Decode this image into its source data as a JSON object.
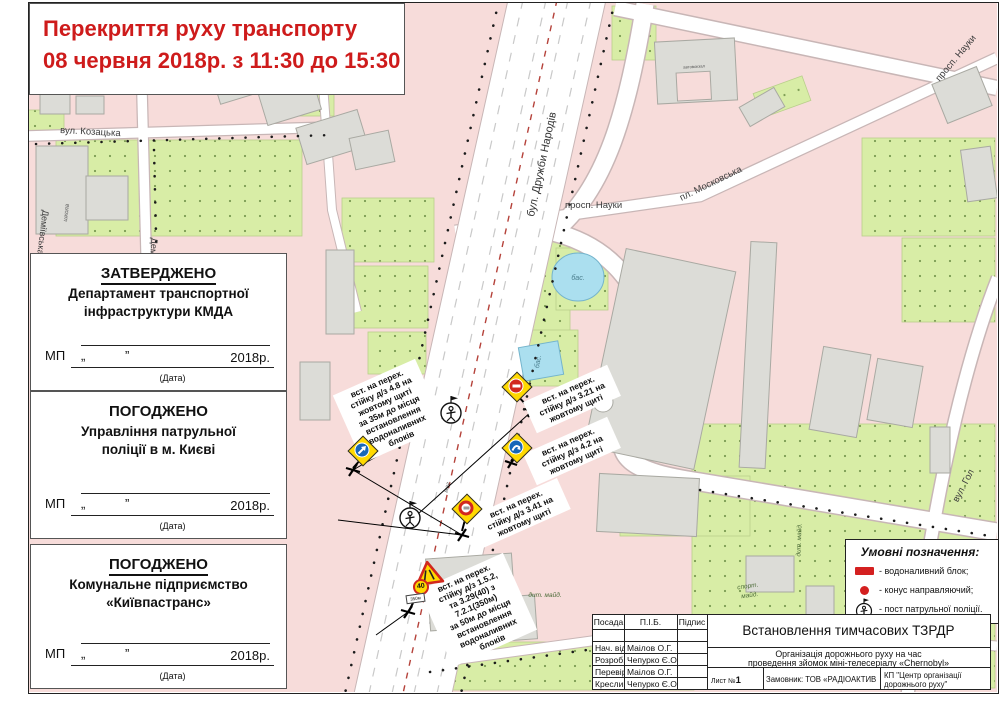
{
  "page_title": {
    "line1": "Перекриття руху транспорту",
    "line2": "08 червня 2018р. з 11:30 до 15:30"
  },
  "approvals": [
    {
      "heading": "ЗАТВЕРДЖЕНО",
      "org1": "Департамент транспортної",
      "org2": "інфраструктури КМДА"
    },
    {
      "heading": "ПОГОДЖЕНО",
      "org1": "Управління патрульної",
      "org2": "поліції в м. Києві"
    },
    {
      "heading": "ПОГОДЖЕНО",
      "org1": "Комунальне підприємство",
      "org2": "«Київпастранс»"
    }
  ],
  "mp_row": {
    "mp": "МП",
    "q1": "„",
    "q2": "”",
    "year": "2018р.",
    "date": "(Дата)"
  },
  "legend": {
    "title": "Умовні позначення:",
    "items": [
      {
        "icon": "water-fill-block-icon",
        "label": "- водоналивний блок;"
      },
      {
        "icon": "guide-cone-icon",
        "label": "- конус направляючий;"
      },
      {
        "icon": "police-post-icon",
        "label": "- пост патрульної поліції."
      }
    ]
  },
  "title_block": {
    "col_posada": "Посада",
    "col_pib": "П.І.Б.",
    "col_pidpys": "Підпис",
    "rows": [
      {
        "role": "Нач. від.",
        "name": "Маілов  О.Г."
      },
      {
        "role": "Розроб.",
        "name": "Чепурко Є.О."
      },
      {
        "role": "Перевір.",
        "name": "Маілов  О.Г."
      },
      {
        "role": "Креслив.",
        "name": "Чепурко Є.О."
      }
    ],
    "doc_title": "Встановлення тимчасових ТЗРДР",
    "subtitle1": "Організація дорожнього руху на час",
    "subtitle2": "проведення зйомок міні-телесеріалу «Chernobyl»",
    "sheet_label": "Лист №",
    "sheet_number": "1",
    "customer": "Замовник: ТОВ «РАДІОАКТИВ СІНЕМА»",
    "company1": "КП \"Центр організації",
    "company2": "дорожнього руху\""
  },
  "annotations": [
    {
      "text": "вст. на перех.\nстійку д/з 4.8 на\nжовтому щиті\nза 35м до місця\nвстановлення\nводоналивних\nблоків"
    },
    {
      "text": "вст. на перех.\nстійку д/з 3.21 на\nжовтому щиті"
    },
    {
      "text": "вст. на перех.\nстійку д/з 4.2 на\nжовтому щиті"
    },
    {
      "text": "вст. на перех.\nстійку д/з 3.41 на\nжовтому щиті"
    },
    {
      "text": "вст. на перех.\nстійку д/з 1.5.2,\nта 3.29(40) з\n7.2.1(350м)\nза 50м до місця\nвстановлення\nводоналивних\nблоків"
    }
  ],
  "signs": {
    "speed": "40",
    "plate": "350м"
  },
  "map_labels": {
    "street_kozatska": "вул. Козацька",
    "street_demiivska": "Деміївська",
    "street_druzhby": "бул. Дружби Народів",
    "ave_nauky": "просп. Науки",
    "ave_nauky_corner": "просп. Науки",
    "sq_moskovska": "пл. Московська",
    "street_hol": "вул. Гол",
    "pool_a": "бас.",
    "pool_b": "бас.",
    "bus_station": "автовокзал",
    "playground_kids": "дит. майд.",
    "playground_kids2": "дит. майд.",
    "playground_sport1": "спорт.",
    "playground_sport2": "майд.",
    "shop": "маг.",
    "school": "школа"
  },
  "colors": {
    "accent_red": "#ce1b1b",
    "sign_red": "#d2281e",
    "sign_blue": "#1767b8",
    "shield_yellow": "#ffd900",
    "map_pink": "#f7dcda",
    "map_green": "#d8eda6",
    "road_white": "#ffffff"
  }
}
